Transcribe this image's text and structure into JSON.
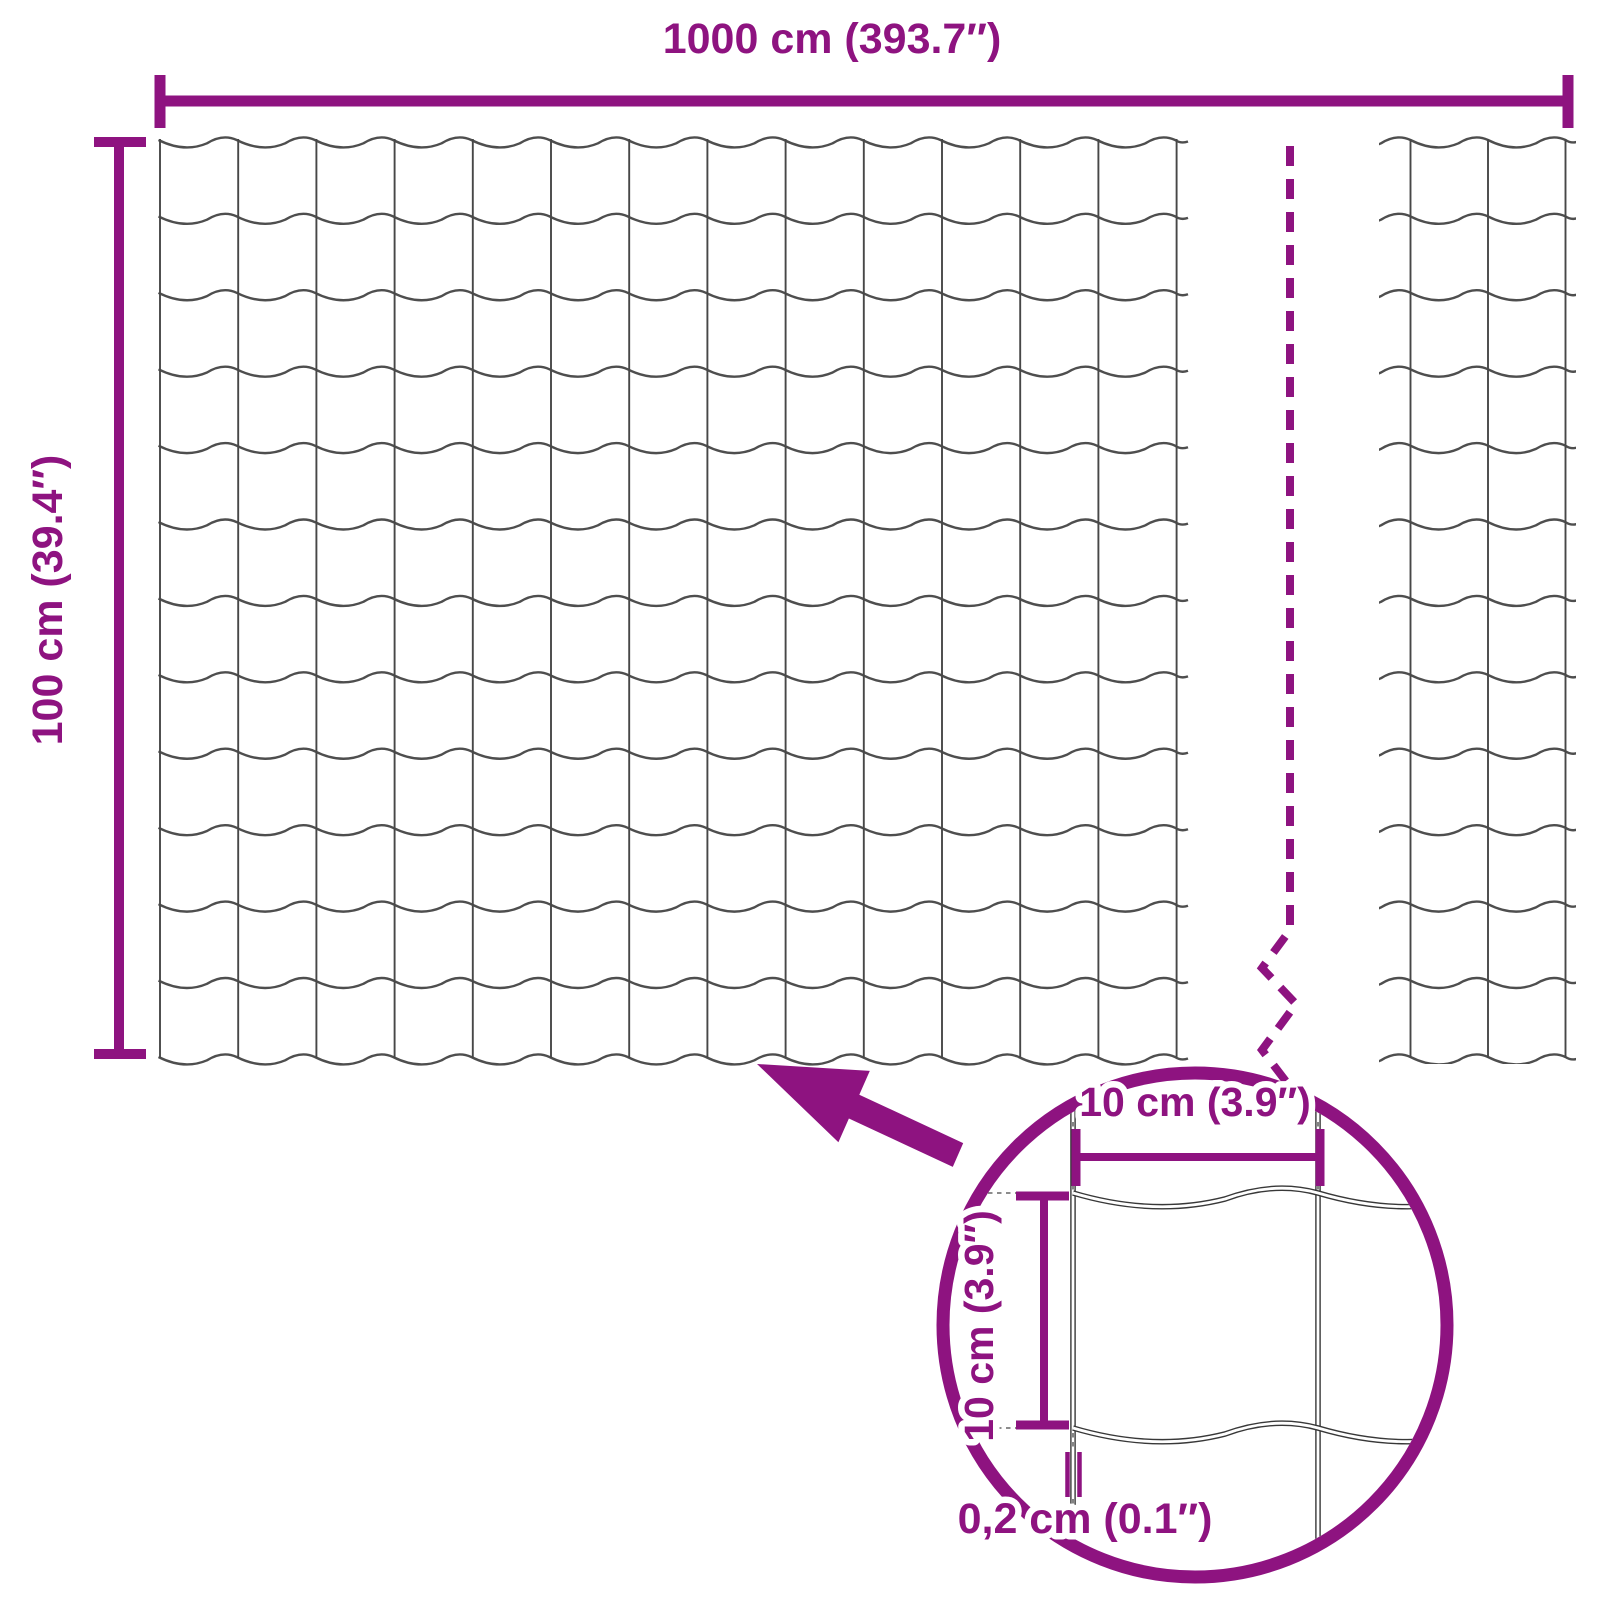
{
  "diagram": {
    "background_color": "#FFFFFF",
    "accent_color": "#8E1380",
    "wire_color": "#4E4E4E",
    "detail_wire_color": "#383838",
    "labels": {
      "total_width": "1000 cm (393.7″)",
      "total_height": "100 cm (39.4″)",
      "detail_cell_width": "10 cm (3.9″)",
      "detail_cell_height": "10 cm (3.9″)",
      "wire_thickness": "0,2 cm (0.1″)"
    },
    "mesh": {
      "columns": 13,
      "rows": 12,
      "right_strip_vertical_wires": 3
    },
    "icons": {
      "zoom_arrow": "arrow-up-left-icon",
      "break_line": "dashed-break-line",
      "magnifier": "detail-circle"
    }
  }
}
